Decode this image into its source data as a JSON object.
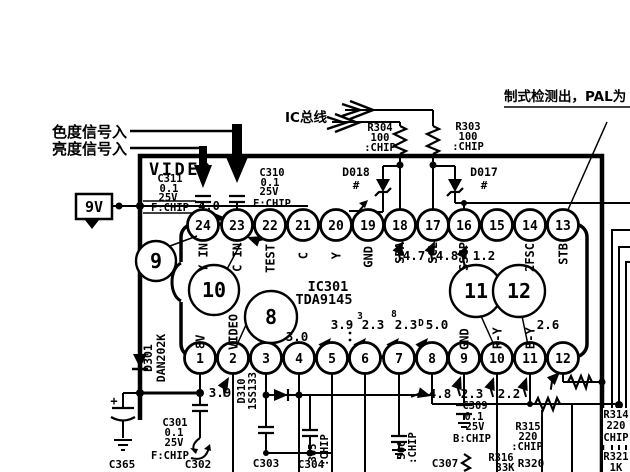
{
  "notes": {
    "chroma_in": "色度信号入",
    "luma_in": "亮度信号入",
    "ic_bus": "IC总线",
    "detect": "制式检测出，PAL为",
    "video": "VIDEO",
    "supply": "9V"
  },
  "ic": {
    "ref": "IC301",
    "part": "TDA9145",
    "top_pins": [
      {
        "num": "24",
        "label": "Y IN"
      },
      {
        "num": "23",
        "label": "C IN"
      },
      {
        "num": "22",
        "label": "TEST"
      },
      {
        "num": "21",
        "label": "C"
      },
      {
        "num": "20",
        "label": "Y"
      },
      {
        "num": "19",
        "label": "GND"
      },
      {
        "num": "18",
        "label": "SDA",
        "volt": "4.7"
      },
      {
        "num": "17",
        "label": "SCL",
        "volt": "4.8"
      },
      {
        "num": "16",
        "label": "SSCP",
        "volt": "1.2"
      },
      {
        "num": "15",
        "label": ""
      },
      {
        "num": "14",
        "label": "2FSC"
      },
      {
        "num": "13",
        "label": "STB"
      }
    ],
    "bottom_pins": [
      {
        "num": "1",
        "label": "8V"
      },
      {
        "num": "2",
        "label": "VIDEO"
      },
      {
        "num": "3",
        "label": ""
      },
      {
        "num": "4",
        "label": "",
        "volt": "3.0"
      },
      {
        "num": "5",
        "label": "",
        "volt": "3.9"
      },
      {
        "num": "6",
        "label": "",
        "volt": "2.3",
        "mark": "3"
      },
      {
        "num": "7",
        "label": "",
        "volt": "2.3",
        "mark": "8"
      },
      {
        "num": "8",
        "label": "",
        "volt": "5.0",
        "mark": "D"
      },
      {
        "num": "9",
        "label": "GND"
      },
      {
        "num": "10",
        "label": "R-Y"
      },
      {
        "num": "11",
        "label": "B-Y"
      },
      {
        "num": "12",
        "label": "",
        "volt": "2.6"
      }
    ]
  },
  "test_points": {
    "tp8": "8",
    "tp9": "9",
    "tp10": "10",
    "tp11": "11",
    "tp12": "12"
  },
  "components": {
    "c311": {
      "ref": "C311",
      "value": "0.1",
      "voltage": "25V",
      "type": "F:CHIP"
    },
    "c310": {
      "ref": "C310",
      "value": "0.1",
      "voltage": "25V",
      "type": "F:CHIP"
    },
    "r304": {
      "ref": "R304",
      "value": "100",
      "type": ":CHIP"
    },
    "r303": {
      "ref": "R303",
      "value": "100",
      "type": ":CHIP"
    },
    "d018": {
      "ref": "D018",
      "mark": "#"
    },
    "d017": {
      "ref": "D017",
      "mark": "#"
    },
    "d301": {
      "ref": "D301",
      "part": "DAN202K"
    },
    "d310": {
      "ref": "D310",
      "part": "1SS133"
    },
    "c301": {
      "ref": "C301",
      "value": "0.1",
      "voltage": "25V",
      "type": "F:CHIP"
    },
    "c302": {
      "ref": "C302"
    },
    "c303": {
      "ref": "C303"
    },
    "c304": {
      "ref": "C304"
    },
    "c305": {
      "ref": "305",
      "type": ":CHIP"
    },
    "c306": {
      "ref": "306",
      "type": ":CHIP"
    },
    "c307": {
      "ref": "C307"
    },
    "c309": {
      "ref": "C309",
      "value": "0.1",
      "voltage": "25V",
      "type": "B:CHIP"
    },
    "c365": {
      "ref": "C365",
      "polarity": "+"
    },
    "r315": {
      "ref": "R315",
      "value": "220",
      "type": ":CHIP"
    },
    "r314": {
      "ref": "R314",
      "value": "220",
      "type": "CHIP"
    },
    "r316": {
      "ref": "R316",
      "value": "33K"
    },
    "r320": {
      "ref": "R320"
    },
    "r321": {
      "ref": "R321",
      "value": "1K"
    }
  },
  "voltages": {
    "pin23_area": "4.0",
    "pin1": "3.9",
    "below_pin9": "4.8",
    "below_pin10": "2.3",
    "below_pin11": "2.2"
  }
}
